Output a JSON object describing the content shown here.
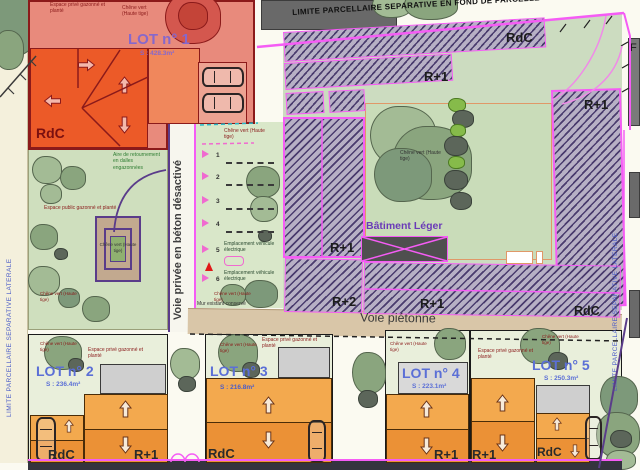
{
  "boundaries": {
    "limite_fond": "LIMITE PARCELLAIRE SEPARATIVE EN FOND DE PARCELLE",
    "limite_left": "LIMITE PARCELLAIRE SEPARATIVE LATERALE",
    "limite_right": "LIMITE PARCELLAIRE SEPARATIVE LATERALE",
    "edge_partial": "F"
  },
  "roads": {
    "voie_privee": "Voie privée en béton désactivé",
    "voie_pietonne": "Voie piétonne"
  },
  "site_labels": {
    "espace_prive": "Espace privé gazonné et planté",
    "espace_public": "Espace public gazonné et planté",
    "chene_vert": "Chêne vert (Haute tige)",
    "aire_retournement": "Aire de retournement en dalles engazonnées",
    "emplacement_ev": "Emplacement véhicule électrique",
    "batiment_leger": "Bâtiment Léger",
    "mur": "Mur existant conservé"
  },
  "floors": {
    "rdc": "RdC",
    "r1": "R+1",
    "r2": "R+2"
  },
  "lots": [
    {
      "name": "LOT n° 1",
      "area": "S : 428.3m²"
    },
    {
      "name": "LOT n° 2",
      "area": "S : 236.4m²"
    },
    {
      "name": "LOT n° 3",
      "area": "S : 216.8m²"
    },
    {
      "name": "LOT n° 4",
      "area": "S : 223.1m²"
    },
    {
      "name": "LOT n° 5",
      "area": "S : 250.3m²"
    }
  ],
  "parking_stalls": [
    "1",
    "2",
    "3",
    "4",
    "5",
    "6"
  ],
  "colors": {
    "lot1_bg": "#e88a7c",
    "building_red_orange": "#ec5a28",
    "lot_building_light": "#f3a94e",
    "lot_building_dark": "#eb9136",
    "hatch_fill": "#b7b0c5",
    "hatch_line": "#4a3c6e",
    "boundary_magenta": "#f55cf5",
    "green_public": "#cfdfbe",
    "green_court": "#c9dcb9",
    "tan_path": "#d9c6a8",
    "label_blue": "#5b6fd6",
    "label_maroon": "#8a1a1a"
  }
}
